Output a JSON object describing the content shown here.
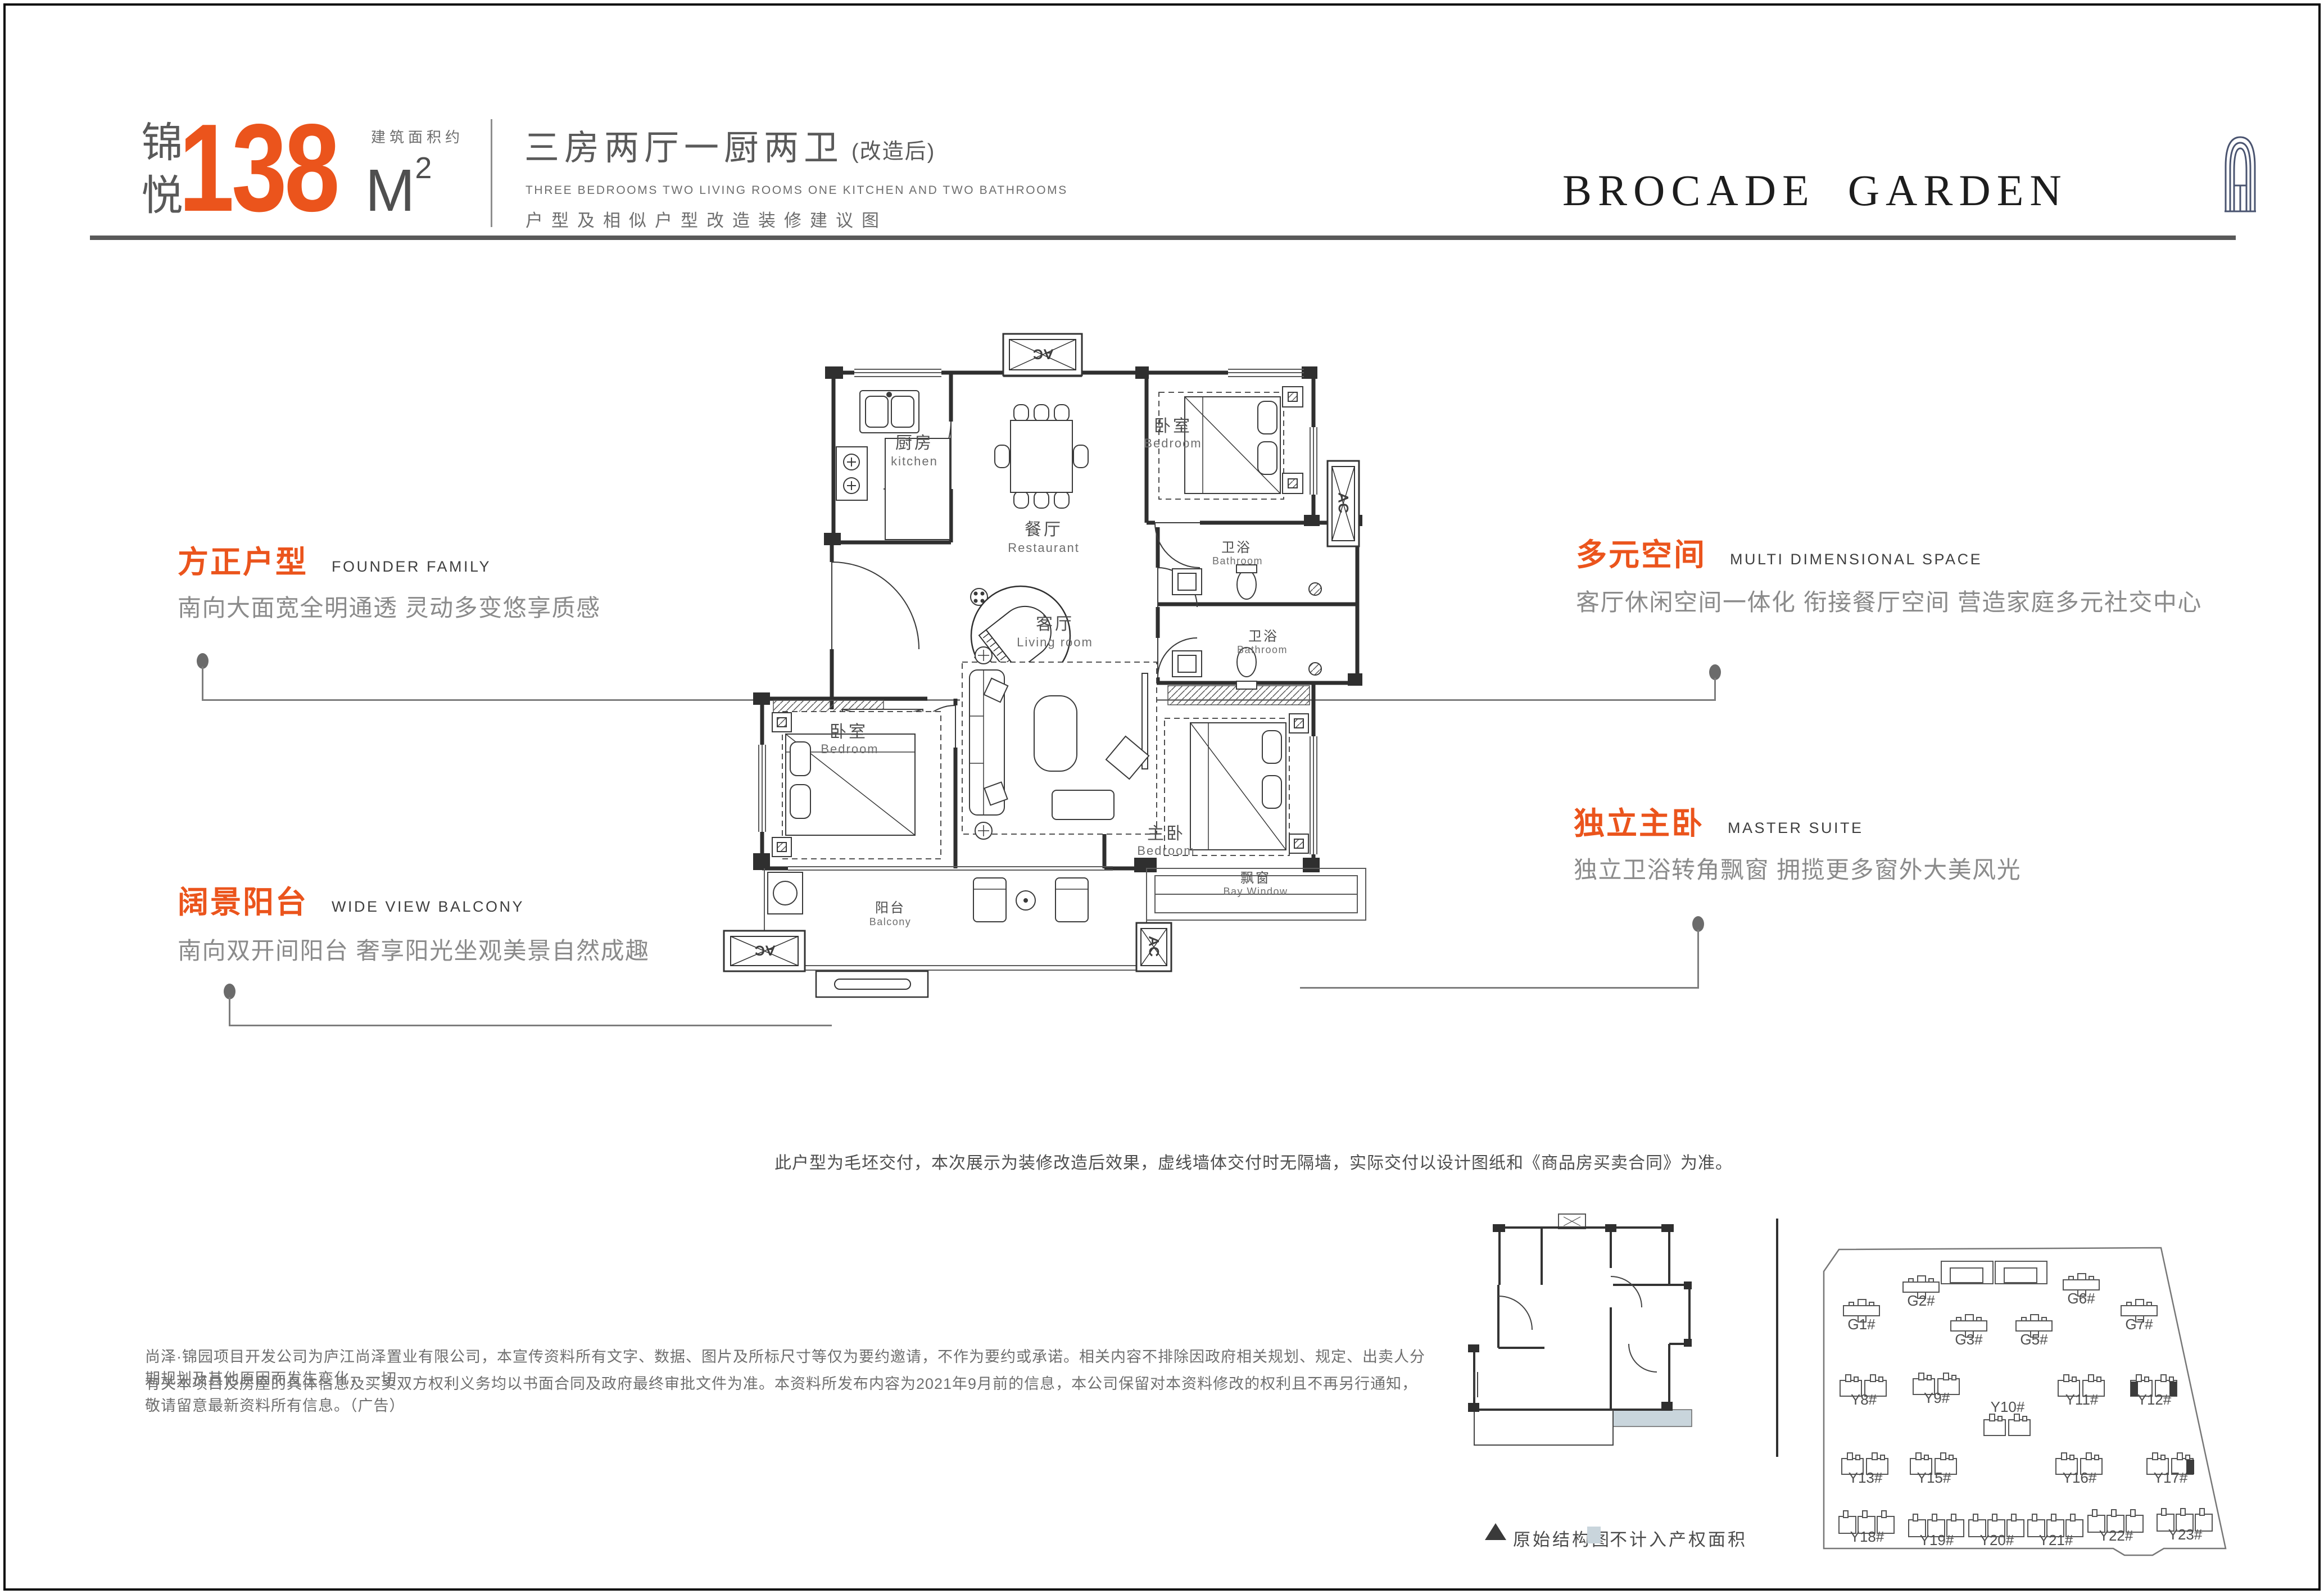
{
  "header": {
    "brand_vertical": "锦悦",
    "area_note": "建筑面积约",
    "area_value": "138",
    "area_unit_sup": "2",
    "layout_title": "三房两厅一厨两卫",
    "layout_suffix": "(改造后)",
    "layout_en": "THREE BEDROOMS  TWO LIVING ROOMS ONE KITCHEN AND TWO BATHROOMS",
    "layout_sub": "户型及相似户型改造装修建议图"
  },
  "logo": {
    "word1": "BROCADE",
    "word2": "GARDEN"
  },
  "callouts": [
    {
      "title": "方正户型",
      "en": "FOUNDER FAMILY",
      "body": "南向大面宽全明通透 灵动多变悠享质感"
    },
    {
      "title": "阔景阳台",
      "en": "WIDE VIEW BALCONY",
      "body": "南向双开间阳台 奢享阳光坐观美景自然成趣"
    },
    {
      "title": "多元空间",
      "en": "MULTI DIMENSIONAL SPACE",
      "body": "客厅休闲空间一体化 衔接餐厅空间 营造家庭多元社交中心"
    },
    {
      "title": "独立主卧",
      "en": "MASTER SUITE",
      "body": "独立卫浴转角飘窗 拥揽更多窗外大美风光"
    }
  ],
  "floorplan": {
    "ac_label": "AC",
    "rooms": {
      "kitchen": {
        "cn": "厨房",
        "en": "kitchen"
      },
      "dining": {
        "cn": "餐厅",
        "en": "Restaurant"
      },
      "bedroom_top": {
        "cn": "卧室",
        "en": "Bedroom"
      },
      "bath_upper": {
        "cn": "卫浴",
        "en": "Bathroom"
      },
      "bath_lower": {
        "cn": "卫浴",
        "en": "Bathroom"
      },
      "living": {
        "cn": "客厅",
        "en": "Living room"
      },
      "bedroom_left": {
        "cn": "卧室",
        "en": "Bedroom"
      },
      "master": {
        "cn": "主卧",
        "en": "Bedroom"
      },
      "bay_window": {
        "cn": "飘窗",
        "en": "Bay Window"
      },
      "balcony": {
        "cn": "阳台",
        "en": "Balcony"
      }
    },
    "note": "此户型为毛坯交付，本次展示为装修改造后效果，虚线墙体交付时无隔墙，实际交付以设计图纸和《商品房买卖合同》为准。"
  },
  "legend": {
    "triangle_label": "原始结构图",
    "square_label": "不计入产权面积"
  },
  "siteplan": {
    "buildings": [
      "G1#",
      "G2#",
      "G3#",
      "G5#",
      "G6#",
      "G7#",
      "Y8#",
      "Y9#",
      "Y10#",
      "Y11#",
      "Y12#",
      "Y13#",
      "Y15#",
      "Y16#",
      "Y17#",
      "Y18#",
      "Y19#",
      "Y20#",
      "Y21#",
      "Y22#",
      "Y23#"
    ]
  },
  "disclaimer": {
    "line1": "尚泽·锦园项目开发公司为庐江尚泽置业有限公司，本宣传资料所有文字、数据、图片及所标尺寸等仅为要约邀请，不作为要约或承诺。相关内容不排除因政府相关规划、规定、出卖人分期规划及其他原因而发生变化，一切",
    "line2": "有关本项目及房屋的具体信息及买卖双方权利义务均以书面合同及政府最终审批文件为准。本资料所发布内容为2021年9月前的信息，本公司保留对本资料修改的权利且不再另行通知，敬请留意最新资料所有信息。（广告）"
  },
  "colors": {
    "accent": "#EB541C",
    "legend_blue": "#C9D5DC",
    "logo_navy": "#4A5470",
    "wall": "#2F2F2F",
    "rule": "#595959"
  }
}
